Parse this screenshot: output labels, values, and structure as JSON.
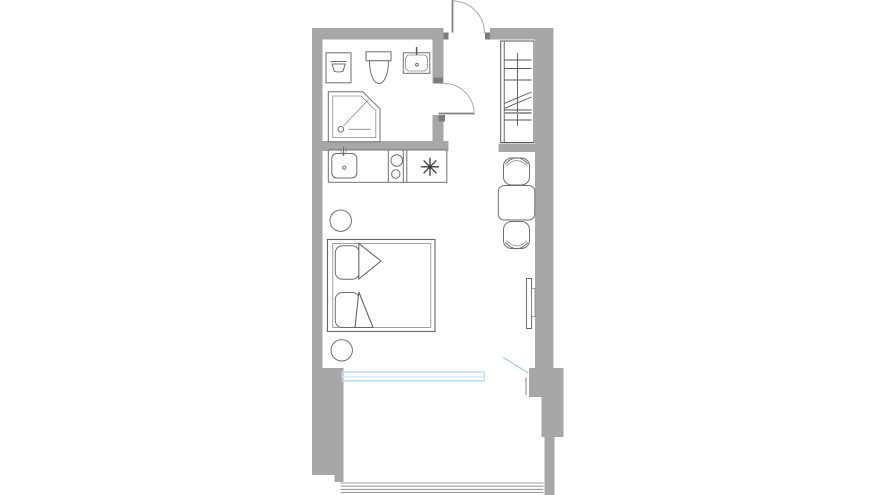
{
  "plan": {
    "kind": "studio-apartment-floor-plan",
    "orientation": "vertical-unit-with-bottom-balcony",
    "colors": {
      "wall": "#a7a7a7",
      "door_stub": "#7c7c7c",
      "fixture_line": "#6f6f6f",
      "detail_line": "#565656",
      "door_swing": "#a9a9a9",
      "door_leaf": "#838383",
      "window_glass": "#b5ddee",
      "window_glass_light": "#d9edf6",
      "balcony_door": "#a9d3e8",
      "railing": "#9b9b9b",
      "background": "#ffffff"
    },
    "elements": [
      "entry-door-with-swing-arc",
      "wardrobe-closet-with-hanging-rod",
      "bathroom",
      "washing-machine",
      "toilet",
      "wash-basin",
      "corner-shower",
      "bathroom-door-with-swing-arc",
      "kitchen-counter",
      "kitchen-sink",
      "two-burner-cooktop",
      "refrigerator-snowflake-symbol",
      "dining-table",
      "dining-chair-top",
      "dining-chair-bottom",
      "wall-mounted-tv",
      "round-side-table-upper",
      "round-side-table-lower",
      "double-bed-with-pillows",
      "panoramic-window",
      "open-balcony-door",
      "balcony",
      "balcony-railing"
    ]
  }
}
